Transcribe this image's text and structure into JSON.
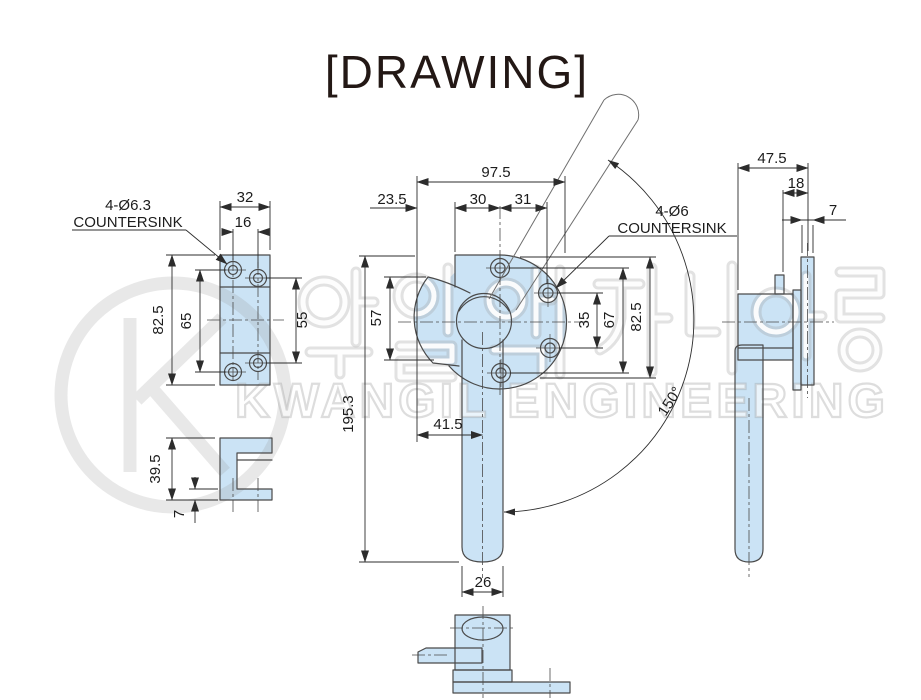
{
  "title": "[DRAWING]",
  "watermark": {
    "logo_letter": "K",
    "korean_text": "광일엔지니어링",
    "company": "KWANGIL ENGINEERING"
  },
  "colors": {
    "part_fill": "#cbe3f5",
    "outline": "#4a4a4a",
    "dimension": "#2c2c2c",
    "watermark_gray": "#e6e6e6",
    "title_color": "#231815"
  },
  "views": {
    "plate": {
      "note1": "4-Ø6.3",
      "note2": "COUNTERSINK",
      "width": "32",
      "hole_cc_width": "16",
      "height": "82.5",
      "hole_cc_left": "65",
      "hole_cc_right": "55"
    },
    "keeper": {
      "height": "39.5",
      "thickness": "7"
    },
    "front": {
      "note1": "4-Ø6",
      "note2": "COUNTERSINK",
      "total_width": "97.5",
      "edge_offset": "23.5",
      "cc_left": "30",
      "cc_right": "31",
      "cam_height": "57",
      "total_height": "195.3",
      "handle_offset": "41.5",
      "handle_width": "26",
      "cc_inner": "35",
      "cc_outer": "67",
      "height": "82.5",
      "swing_angle": "150°"
    },
    "side": {
      "depth": "47.5",
      "offset": "18",
      "flange_thickness": "7"
    }
  }
}
